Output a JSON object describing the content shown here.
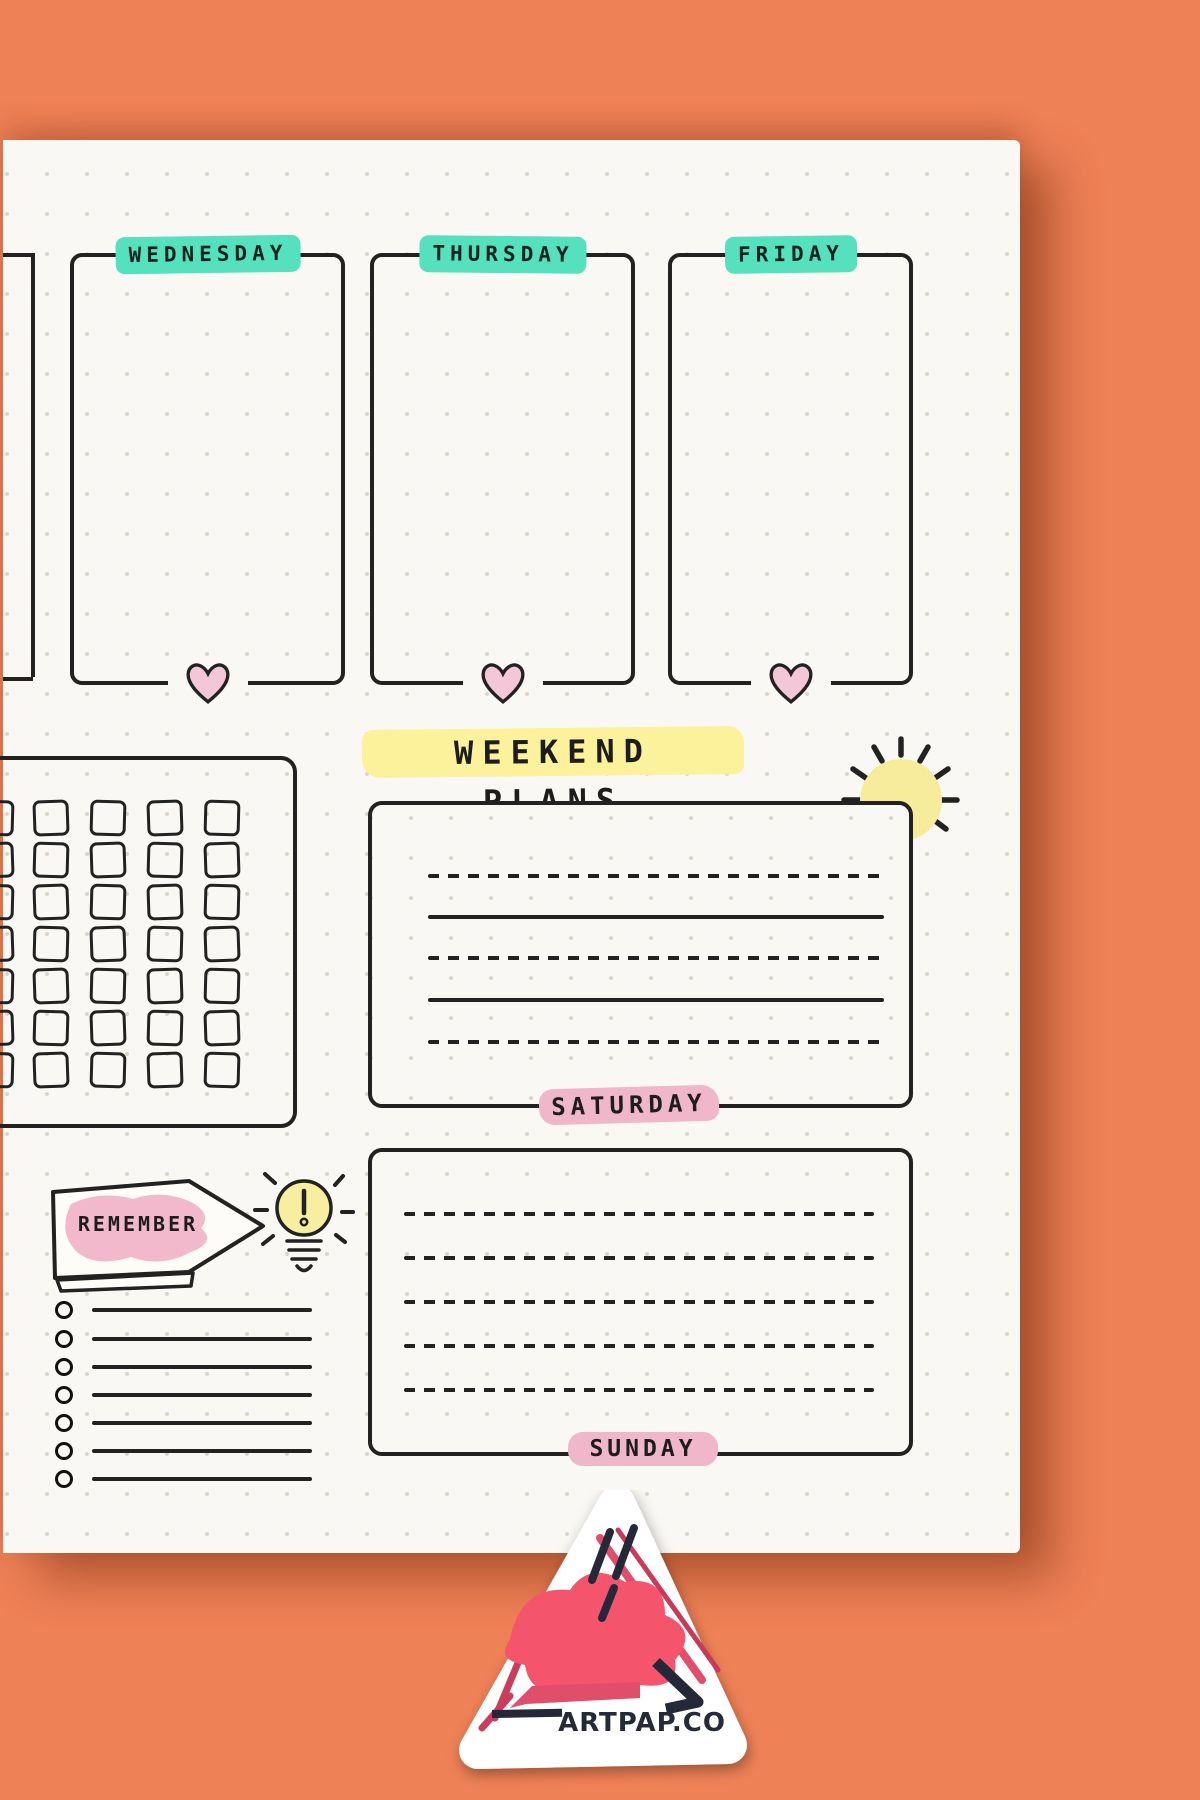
{
  "planner": {
    "days": [
      "WEDNESDAY",
      "THURSDAY",
      "FRIDAY"
    ],
    "weekend_title": "WEEKEND PLANS",
    "saturday": {
      "label": "SATURDAY",
      "lines": [
        "dashed",
        "solid",
        "dashed",
        "solid",
        "dashed"
      ]
    },
    "sunday": {
      "label": "SUNDAY",
      "lines": [
        "dashed",
        "dashed",
        "dashed",
        "dashed",
        "dashed"
      ]
    },
    "remember_label": "REMEMBER",
    "habit_tracker": {
      "rows": 7,
      "cols": 5
    },
    "checklist_rows": 7,
    "icons": [
      "heart-icon",
      "sun-icon",
      "lightbulb-icon"
    ]
  },
  "branding": {
    "logo_text": "ARTPAP.CO"
  },
  "colors": {
    "background_orange": "#EF8156",
    "paper": "#FAF8F4",
    "ink": "#222222",
    "teal_highlight": "#55E1BD",
    "yellow_highlight": "#FBF29B",
    "sun_yellow": "#F7EC9B",
    "heart_pink": "#F3C7D7",
    "pink_highlight": "#F0B6C9",
    "sticker_pink": "#F4546C",
    "sticker_crimson": "#CB3D5C",
    "sticker_navy": "#242839"
  }
}
